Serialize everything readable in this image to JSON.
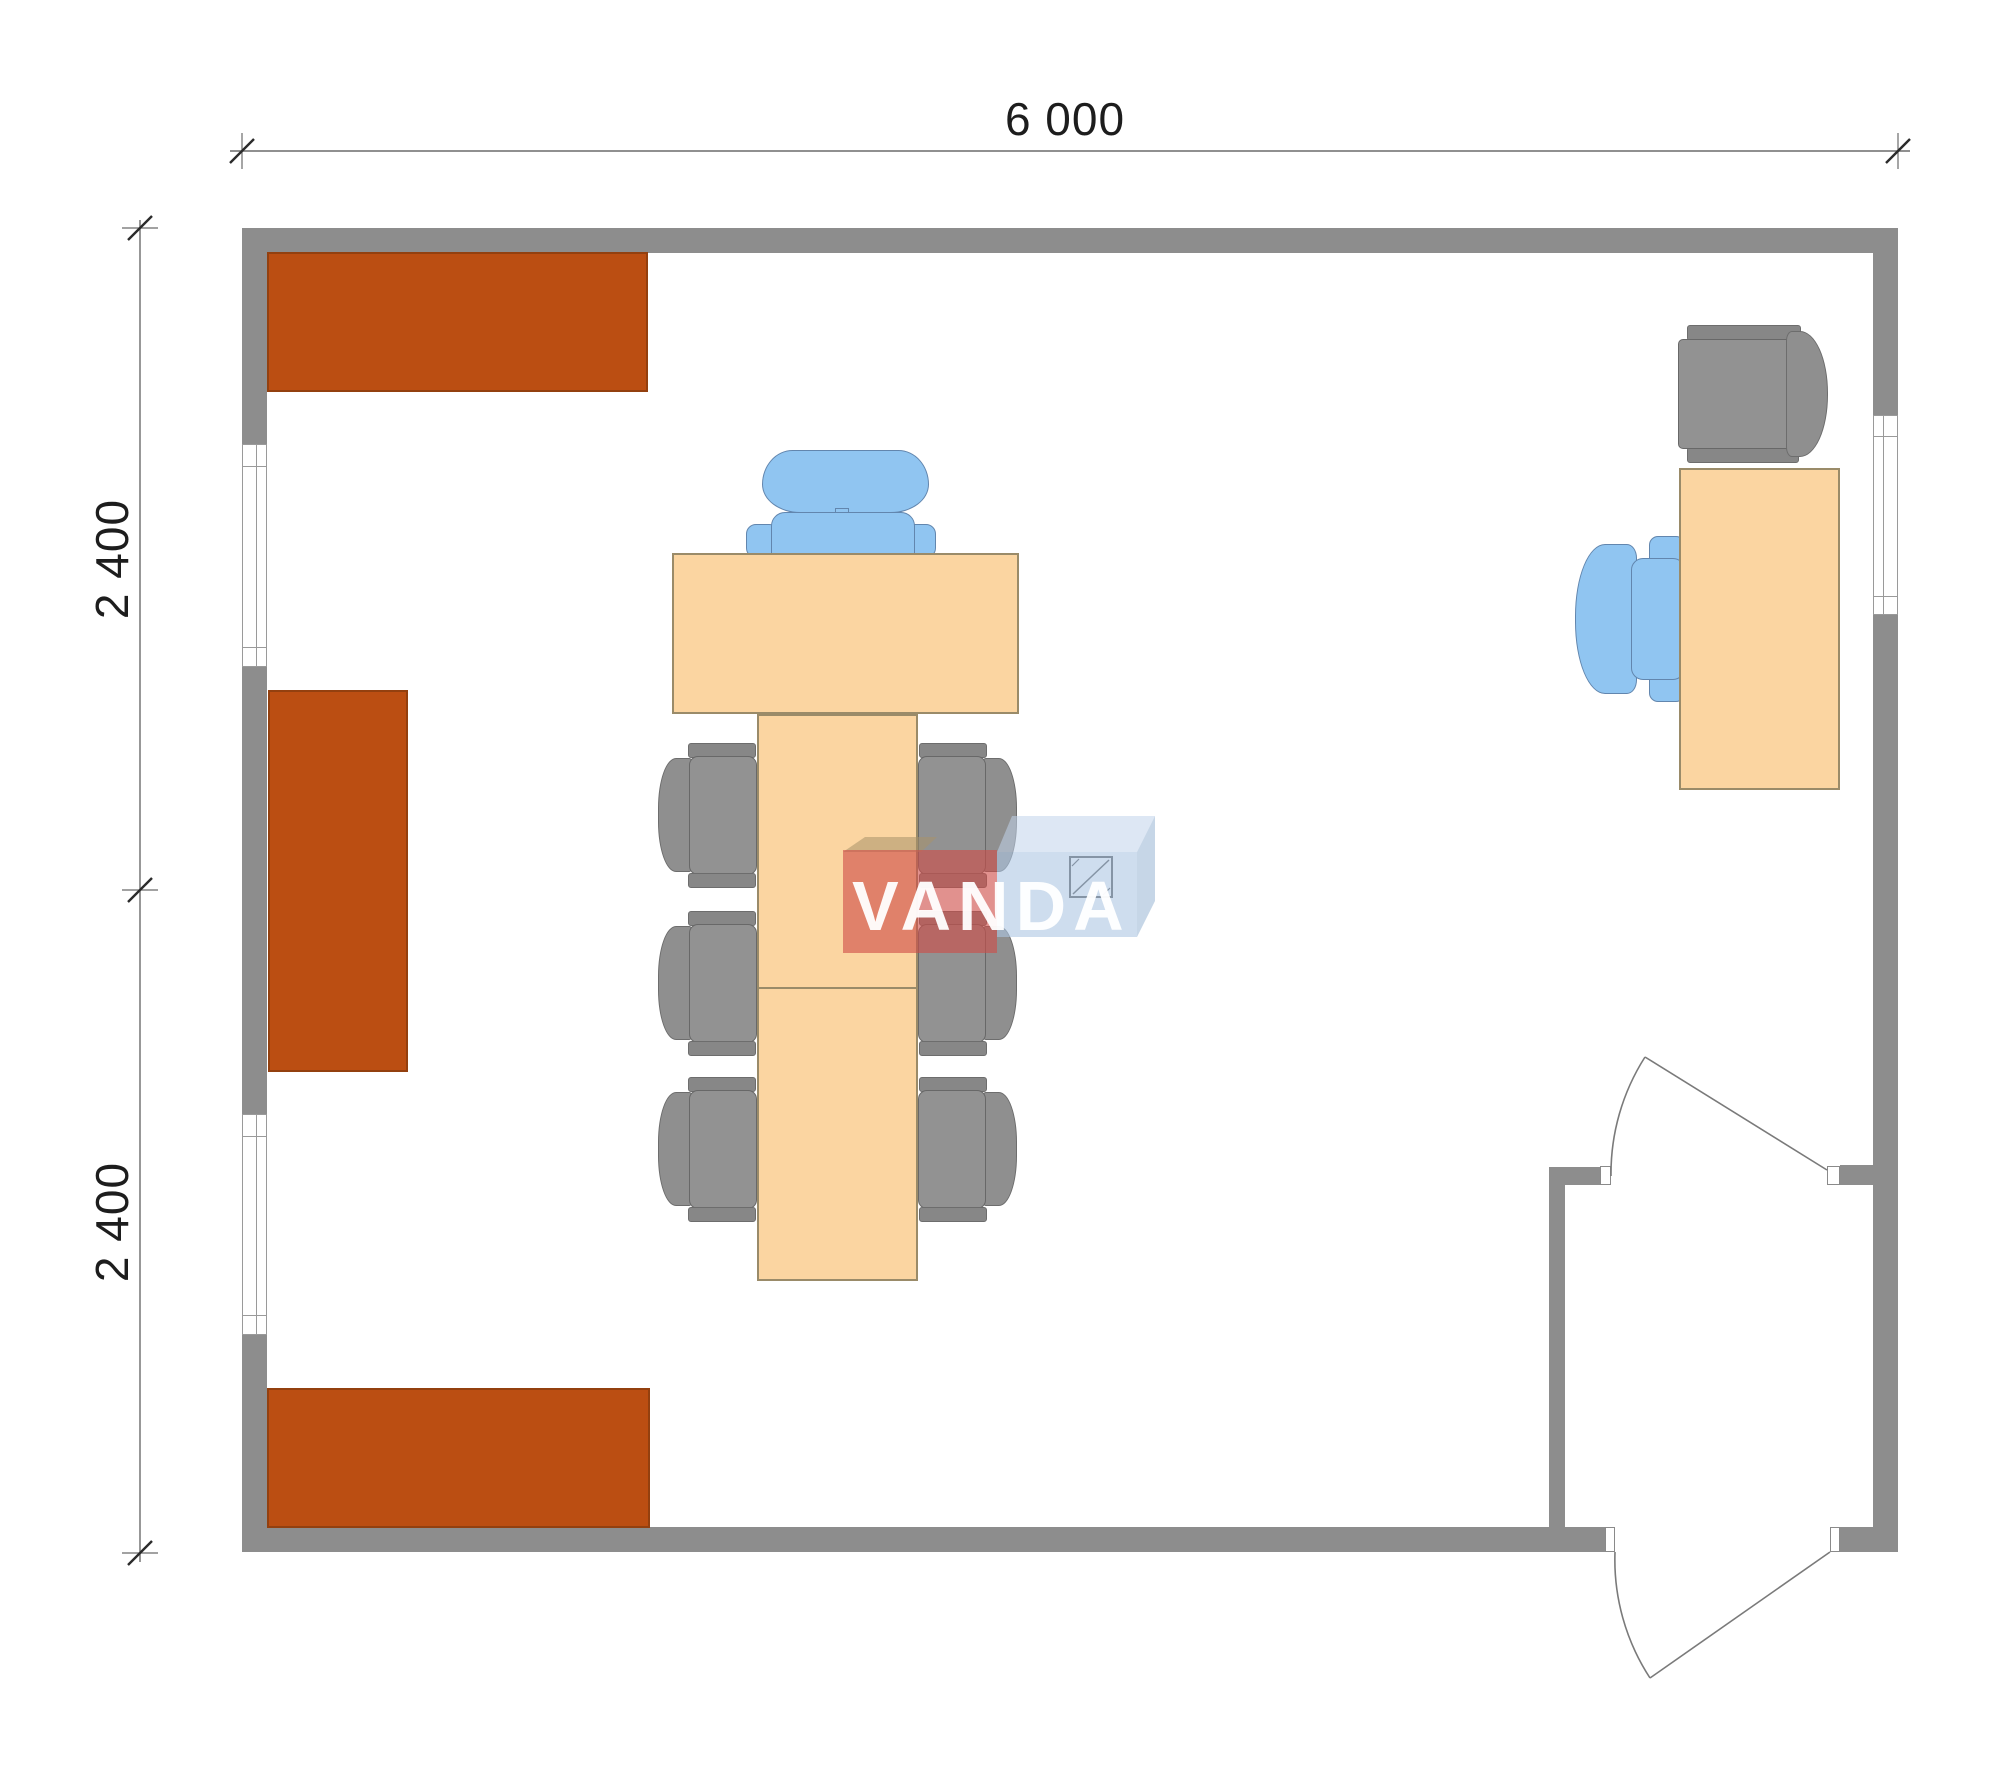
{
  "plan": {
    "type": "office-module-floor-plan",
    "dimensions": {
      "width_label": "6 000",
      "height_upper_label": "2 400",
      "height_lower_label": "2 400"
    },
    "watermark": {
      "text": "VANDA"
    },
    "colors": {
      "wall": "#8d8d8d",
      "cabinet": "#bb4e12",
      "table": "#fbd5a1",
      "chair_gray": "#8f8f8f",
      "chair_blue": "#90c5f1",
      "watermark_red": "rgba(206,78,72,0.62)",
      "watermark_blue": "rgba(173,198,227,0.60)",
      "dimension_text": "#1d1d1d"
    }
  }
}
